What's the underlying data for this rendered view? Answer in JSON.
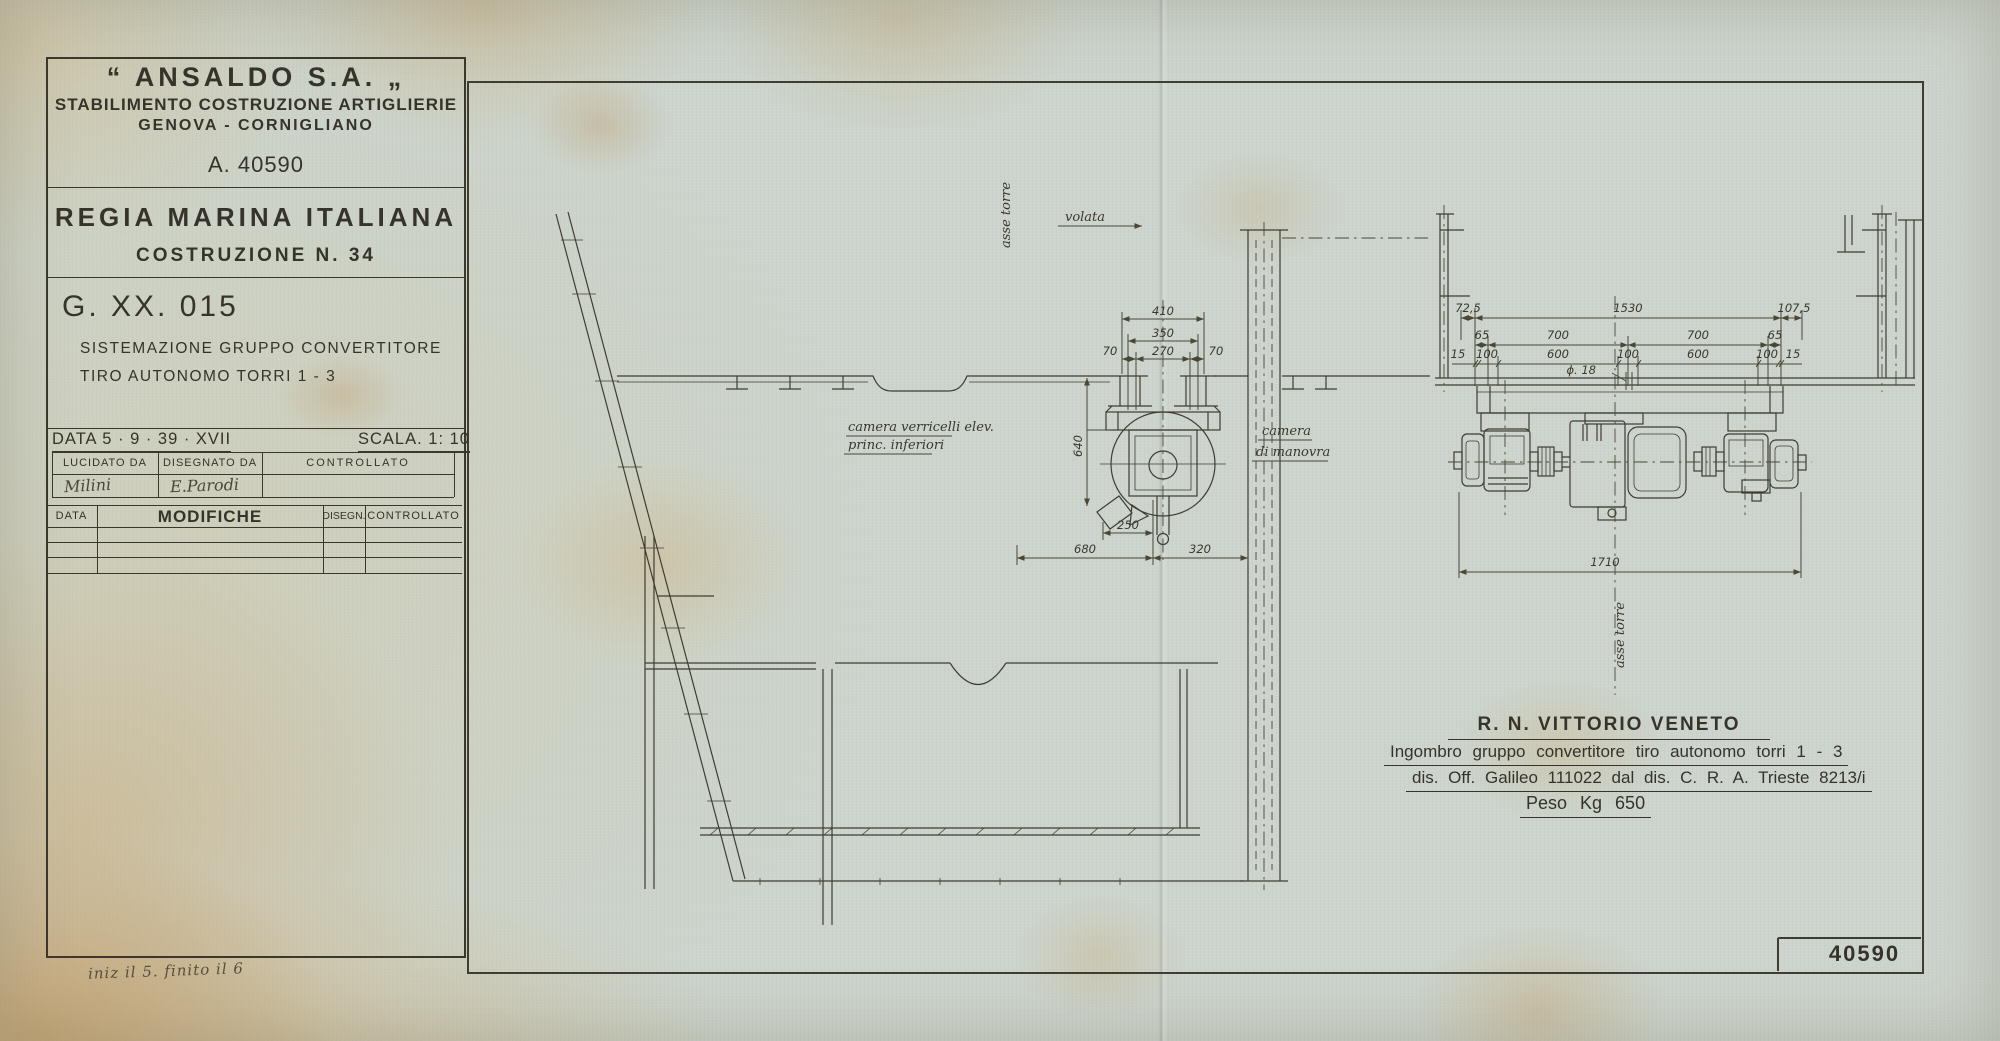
{
  "title_block": {
    "company": "“ ANSALDO  S.A. „",
    "factory": "STABILIMENTO COSTRUZIONE ARTIGLIERIE",
    "location": "GENOVA - CORNIGLIANO",
    "registry": "A. 40590",
    "navy": "REGIA  MARINA  ITALIANA",
    "construction": "COSTRUZIONE  N. 34",
    "drawing_number": "G. XX. 015",
    "subject_line1": "SISTEMAZIONE  GRUPPO  CONVERTITORE",
    "subject_line2": "TIRO  AUTONOMO  TORRI  1 - 3",
    "date_label": "DATA  5 · 9 · 39 · XVII",
    "scale_label": "SCALA. 1: 10",
    "sig_table": {
      "headers": [
        "LUCIDATO DA",
        "DISEGNATO DA",
        "CONTROLLATO"
      ],
      "values": [
        "Milini",
        "E.Parodi",
        ""
      ]
    },
    "mod_table": {
      "headers": [
        "DATA",
        "MODIFICHE",
        "DISEGN.",
        "CONTROLLATO"
      ]
    },
    "hand_note": "iniz il 5. finito il 6"
  },
  "drawing_labels": {
    "asse_torre_plan": "asse torre",
    "volata": "volata",
    "camera_verricelli_line1": "camera verricelli elev.",
    "camera_verricelli_line2": "princ. inferiori",
    "camera_manovra_line1": "camera",
    "camera_manovra_line2": "di manovra",
    "asse_torre_elev": "asse torre"
  },
  "dims": {
    "plan_410": "410",
    "plan_350": "350",
    "plan_270": "270",
    "plan_70_left": "70",
    "plan_70_right": "70",
    "plan_640": "640",
    "plan_250": "250",
    "plan_680": "680",
    "plan_320": "320",
    "elev_72_5": "72,5",
    "elev_1530": "1530",
    "elev_107_5": "107,5",
    "elev_65_left": "65",
    "elev_700_left": "700",
    "elev_700_right": "700",
    "elev_65_right": "65",
    "elev_15_left": "15",
    "elev_100_a": "100",
    "elev_600_left": "600",
    "elev_100_b": "100",
    "elev_600_right": "600",
    "elev_100_c": "100",
    "elev_15_right": "15",
    "elev_dia_18": "ϕ. 18",
    "elev_1710": "1710"
  },
  "notes": {
    "ship": "R. N. VITTORIO  VENETO",
    "line1": "Ingombro  gruppo  convertitore  tiro  autonomo   torri   1 - 3",
    "line2": "dis. Off. Galileo  111022   dal  dis. C. R. A.  Trieste   8213/i",
    "line3": "Peso   Kg  650"
  },
  "sheet_number": "40590",
  "colors": {
    "paper": "#ccd4cd",
    "ink": "#35332a",
    "line": "#3f3d32",
    "stain": "#c9a36a"
  }
}
